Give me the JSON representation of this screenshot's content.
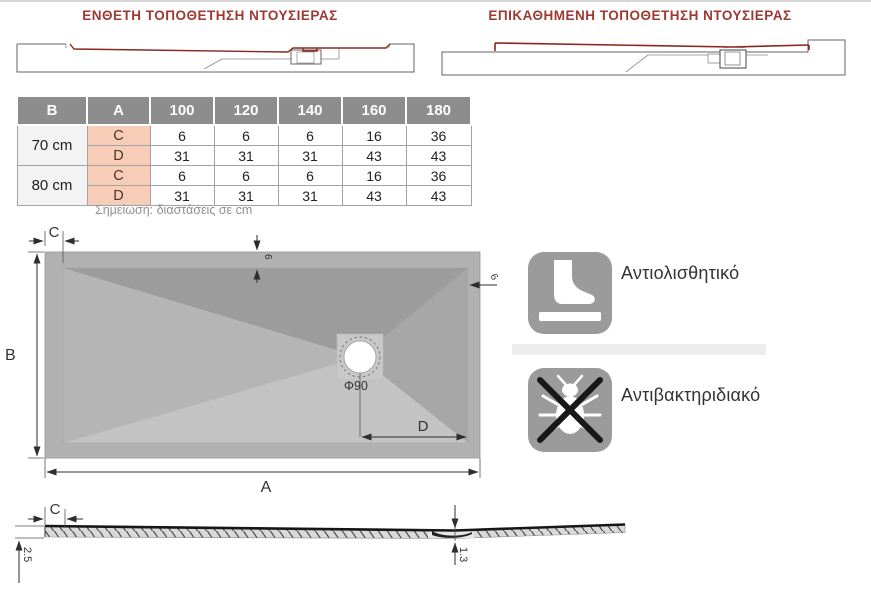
{
  "titles": {
    "inset": "ΕΝΘΕΤΗ ΤΟΠΟΘΕΤΗΣΗ ΝΤΟΥΣΙΕΡΑΣ",
    "surface": "ΕΠΙΚΑΘΗΜΕΝΗ ΤΟΠΟΘΕΤΗΣΗ ΝΤΟΥΣΙΕΡΑΣ"
  },
  "table": {
    "col_headers": [
      "B",
      "A",
      "100",
      "120",
      "140",
      "160",
      "180"
    ],
    "row_groups": [
      {
        "size": "70 cm",
        "rows": [
          {
            "dim": "C",
            "values": [
              "6",
              "6",
              "6",
              "16",
              "36"
            ]
          },
          {
            "dim": "D",
            "values": [
              "31",
              "31",
              "31",
              "43",
              "43"
            ]
          }
        ]
      },
      {
        "size": "80 cm",
        "rows": [
          {
            "dim": "C",
            "values": [
              "6",
              "6",
              "6",
              "16",
              "36"
            ]
          },
          {
            "dim": "D",
            "values": [
              "31",
              "31",
              "31",
              "43",
              "43"
            ]
          }
        ]
      }
    ],
    "note": "Σημείωση: διαστάσεις σε cm"
  },
  "top_view": {
    "dim_a": "A",
    "dim_b": "B",
    "dim_c": "C",
    "dim_d": "D",
    "rim_top": "6",
    "rim_right": "6",
    "drain": "Φ90"
  },
  "features": [
    {
      "label": "Αντιολισθητικό",
      "icon": "foot-on-surface-icon"
    },
    {
      "label": "Αντιβακτηριδιακό",
      "icon": "crossed-bacteria-icon"
    }
  ],
  "profile": {
    "dim_c": "C",
    "edge_thickness": "2.5",
    "drain_thickness": "1.3"
  },
  "colors": {
    "title_red": "#9d392f",
    "profile_red": "#8b271e",
    "table_header_bg": "#8d8d8d",
    "size_cell_bg": "#f3f3f3",
    "dim_cell_bg": "#f7cdb8",
    "tray_rim": "#b1b1b1",
    "icon_tile": "#9b9b9b"
  }
}
